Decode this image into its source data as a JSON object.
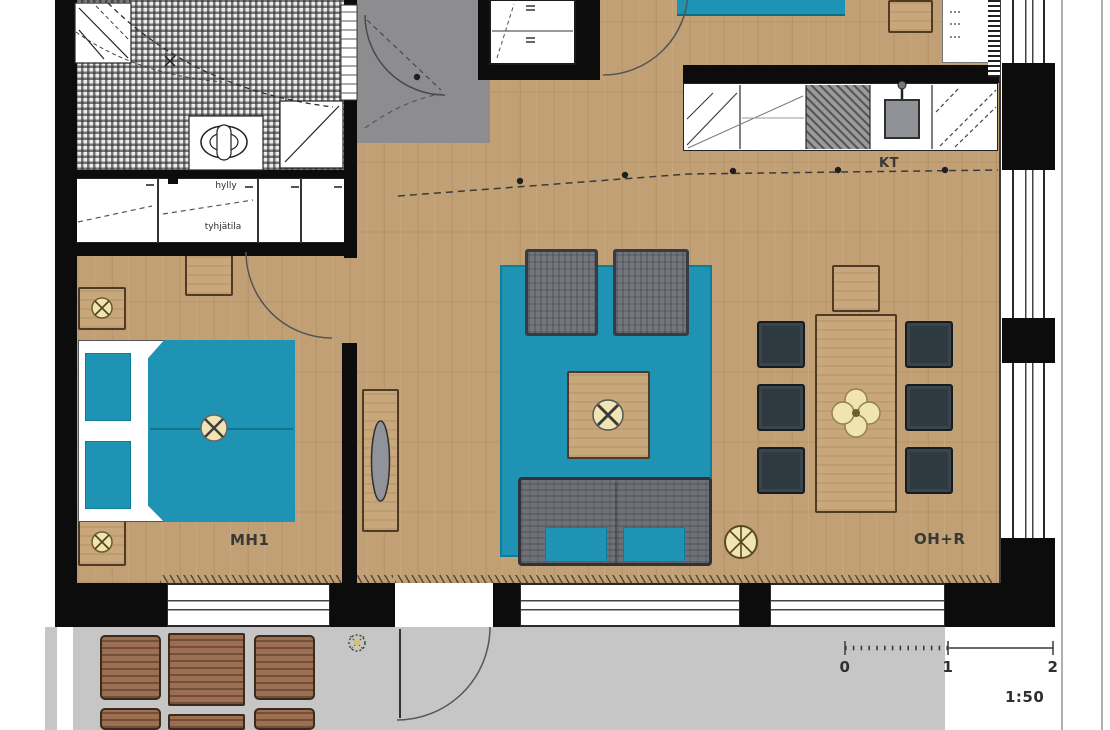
{
  "title": "apartment-floor-plan",
  "labels": {
    "bedroom": "MH1",
    "kitchen": "KT",
    "living_room": "OH+R",
    "closet_shelf": "hylly",
    "closet_lower": "tyhjätila"
  },
  "scale_bar": {
    "start": "0",
    "mid": "1",
    "end": "2",
    "ratio": "1:50"
  },
  "colors": {
    "wood": "#c2a075",
    "teal": "#1e93b4",
    "entry_gray": "#8d8d8f",
    "balcony_gray": "#c6c6c6",
    "wall": "#0c0c0c",
    "chair_dark": "#2e3940",
    "sofa_gray": "#73767c",
    "furn_wood": "#c8a77b",
    "balcony_wood": "#9c6f52",
    "cream": "#f1e4b3",
    "line": "#333333"
  }
}
